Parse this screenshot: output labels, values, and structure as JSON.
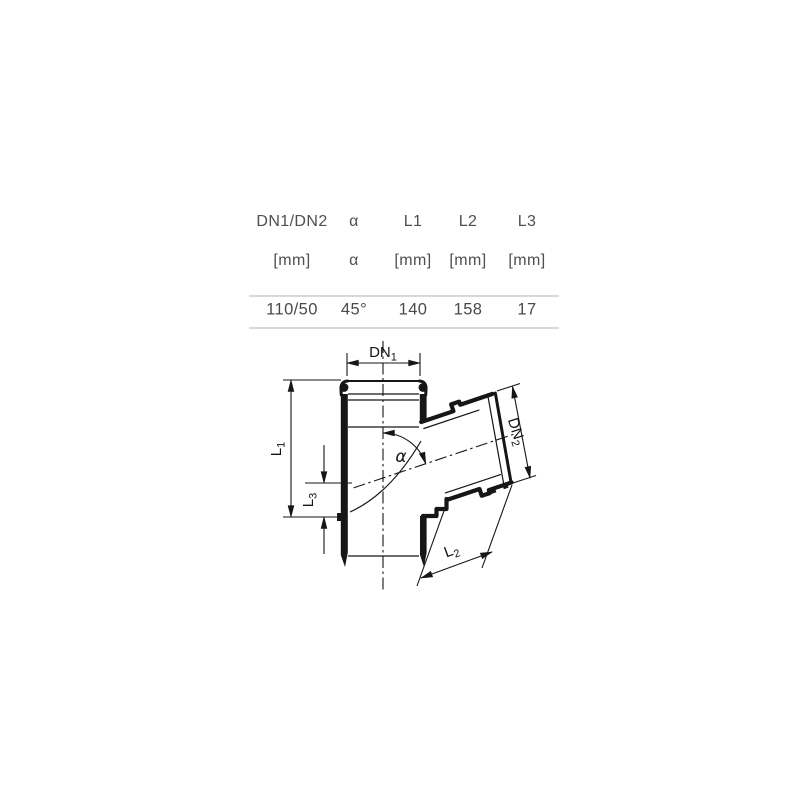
{
  "table": {
    "columns": [
      {
        "header": "DN1/DN2",
        "unit": "[mm]",
        "value": "110/50"
      },
      {
        "header": "α",
        "unit": "α",
        "value": "45°"
      },
      {
        "header": "L1",
        "unit": "[mm]",
        "value": "140"
      },
      {
        "header": "L2",
        "unit": "[mm]",
        "value": "158"
      },
      {
        "header": "L3",
        "unit": "[mm]",
        "value": "17"
      }
    ],
    "text_color": "#4f4f4f",
    "divider_color": "#d9d9d9"
  },
  "drawing": {
    "type": "technical-drawing-45-degree-branch-pipe-fitting",
    "line_color": "#161616",
    "background": "#ffffff",
    "labels": {
      "dn1": {
        "text": "DN",
        "sub": "1"
      },
      "dn2": {
        "text": "DN",
        "sub": "2"
      },
      "l1": {
        "text": "L",
        "sub": "1"
      },
      "l2": {
        "text": "L",
        "sub": "2"
      },
      "l3": {
        "text": "L",
        "sub": "3"
      },
      "alpha": "α"
    }
  }
}
